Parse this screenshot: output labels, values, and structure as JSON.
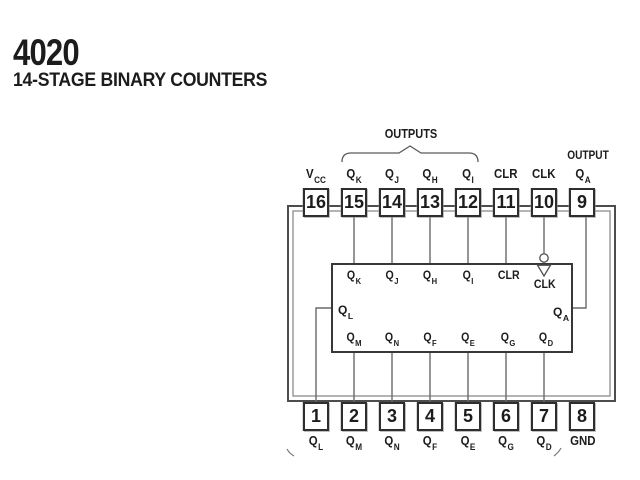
{
  "header": {
    "part_number": "4020",
    "description": "14-STAGE BINARY COUNTERS"
  },
  "annotations": {
    "outputs_group": "OUTPUTS",
    "output_single": "OUTPUT"
  },
  "pins": {
    "top": [
      {
        "number": "16",
        "name": "V",
        "sub": "CC"
      },
      {
        "number": "15",
        "name": "Q",
        "sub": "K"
      },
      {
        "number": "14",
        "name": "Q",
        "sub": "J"
      },
      {
        "number": "13",
        "name": "Q",
        "sub": "H"
      },
      {
        "number": "12",
        "name": "Q",
        "sub": "I"
      },
      {
        "number": "11",
        "name": "CLR",
        "sub": ""
      },
      {
        "number": "10",
        "name": "CLK",
        "sub": ""
      },
      {
        "number": "9",
        "name": "Q",
        "sub": "A"
      }
    ],
    "bottom": [
      {
        "number": "1",
        "name": "Q",
        "sub": "L"
      },
      {
        "number": "2",
        "name": "Q",
        "sub": "M"
      },
      {
        "number": "3",
        "name": "Q",
        "sub": "N"
      },
      {
        "number": "4",
        "name": "Q",
        "sub": "F"
      },
      {
        "number": "5",
        "name": "Q",
        "sub": "E"
      },
      {
        "number": "6",
        "name": "Q",
        "sub": "G"
      },
      {
        "number": "7",
        "name": "Q",
        "sub": "D"
      },
      {
        "number": "8",
        "name": "GND",
        "sub": ""
      }
    ]
  },
  "logic_block": {
    "top_ports": [
      {
        "name": "Q",
        "sub": "K"
      },
      {
        "name": "Q",
        "sub": "J"
      },
      {
        "name": "Q",
        "sub": "H"
      },
      {
        "name": "Q",
        "sub": "I"
      },
      {
        "name": "CLR",
        "sub": ""
      },
      {
        "name": "CLK",
        "sub": ""
      }
    ],
    "left_port": {
      "name": "Q",
      "sub": "L"
    },
    "right_port": {
      "name": "Q",
      "sub": "A"
    },
    "bottom_ports": [
      {
        "name": "Q",
        "sub": "M"
      },
      {
        "name": "Q",
        "sub": "N"
      },
      {
        "name": "Q",
        "sub": "F"
      },
      {
        "name": "Q",
        "sub": "E"
      },
      {
        "name": "Q",
        "sub": "G"
      },
      {
        "name": "Q",
        "sub": "D"
      }
    ]
  },
  "colors": {
    "ink": "#1c1c1c",
    "wire": "#6a6a6a",
    "outline": "#4d4d4d",
    "box_border": "#2e2e2e"
  }
}
